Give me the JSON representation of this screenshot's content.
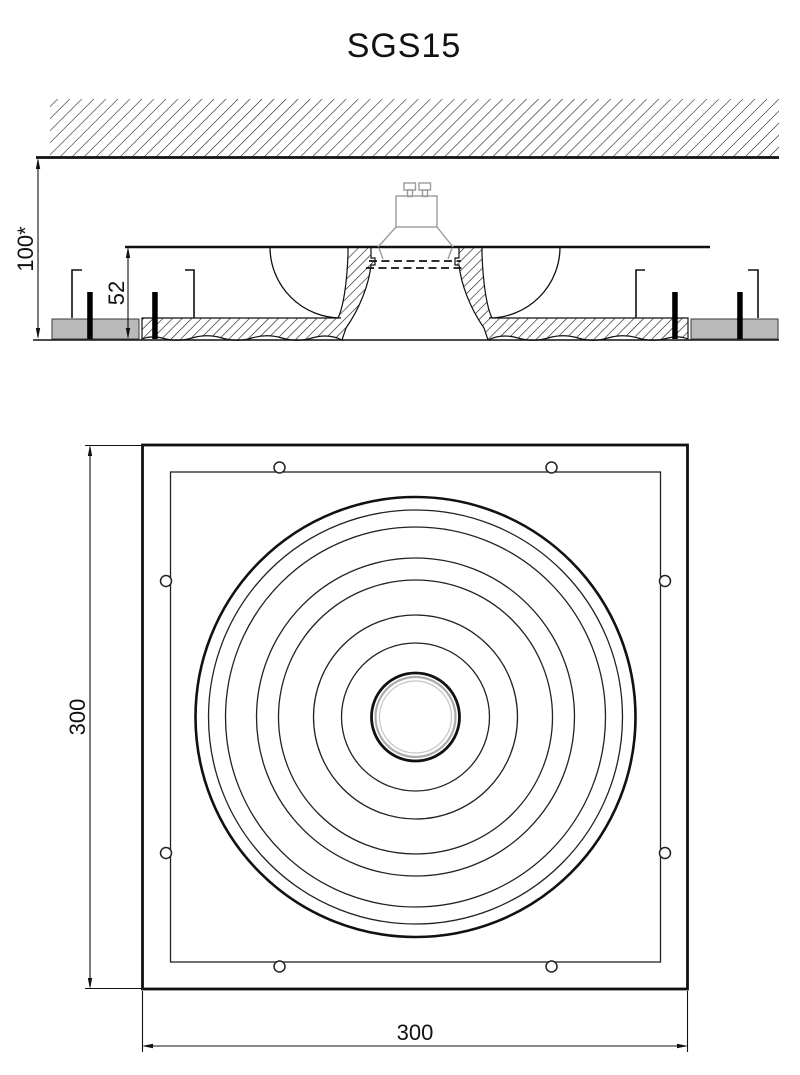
{
  "title": "SGS15",
  "dimensions": {
    "recess_depth": "100*",
    "fixture_height": "52",
    "plan_height": "300",
    "plan_width": "300"
  },
  "colors": {
    "line": "#1a1a1a",
    "lamp_outline": "#9b9b9b",
    "plasterboard_fill": "#b9b9b9",
    "trim_ring_gray": "#ababab",
    "background": "#ffffff"
  }
}
